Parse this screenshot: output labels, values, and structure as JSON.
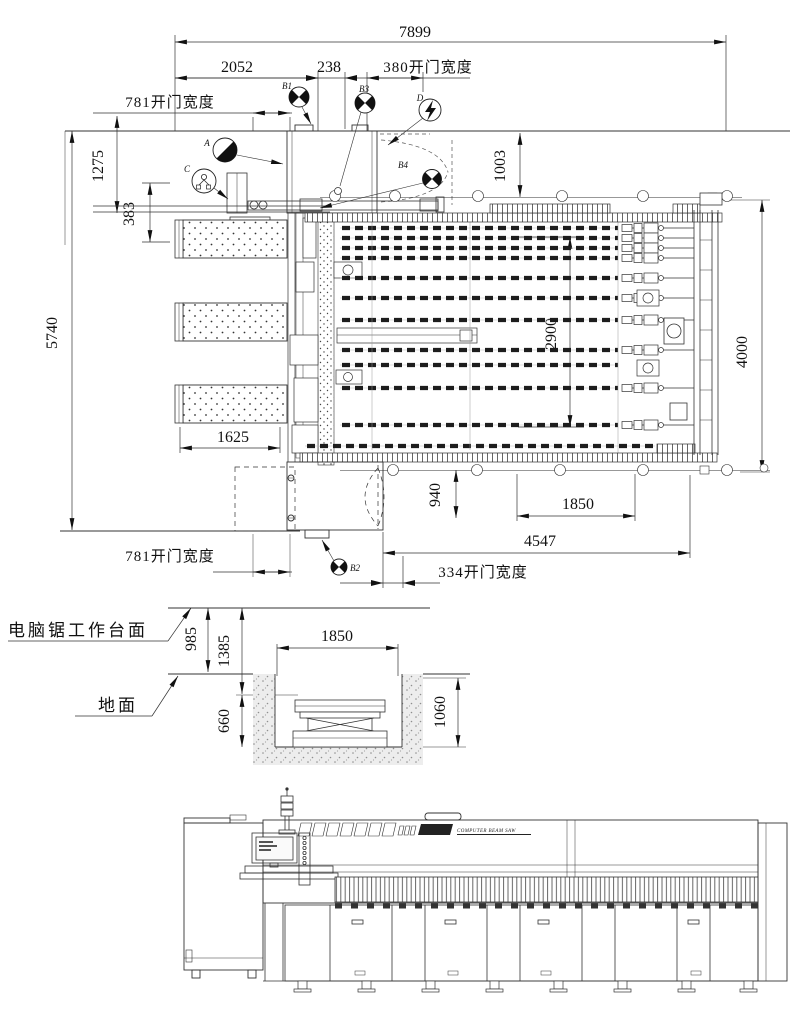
{
  "drawing": {
    "kind": "machine-installation-layout",
    "line_color": "#222222",
    "bg_color": "#ffffff"
  },
  "plan": {
    "dims": {
      "overall_width": "7899",
      "seg_2052": "2052",
      "seg_238": "238",
      "door_380": "380开门宽度",
      "door_781_top": "781开门宽度",
      "left_1275": "1275",
      "left_383": "383",
      "overall_depth": "5740",
      "table_1625": "1625",
      "offset_1003": "1003",
      "span_2900": "2900",
      "right_4000": "4000",
      "offset_940": "940",
      "lift_1850": "1850",
      "span_4547": "4547",
      "door_334": "334开门宽度",
      "door_781_bottom": "781开门宽度"
    },
    "callouts": {
      "a": "A",
      "b1": "B1",
      "b2": "B2",
      "b3": "B3",
      "b4": "B4",
      "c": "C",
      "d": "D"
    }
  },
  "section": {
    "labels": {
      "worktable": "电脑锯工作台面",
      "ground": "地面"
    },
    "dims": {
      "height_985": "985",
      "height_1385": "1385",
      "pit_1850": "1850",
      "lift_660": "660",
      "pit_1060": "1060"
    }
  },
  "elevation": {
    "logo_subtitle": "COMPUTER BEAM SAW"
  }
}
